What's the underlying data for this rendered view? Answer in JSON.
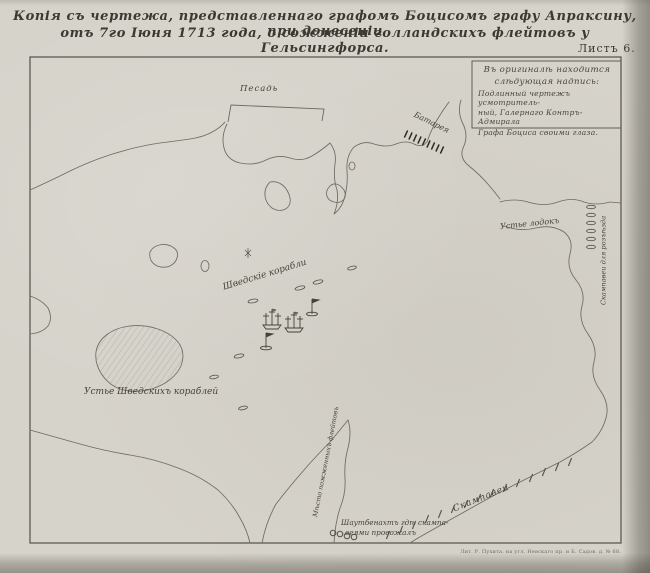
{
  "title": {
    "line1": "Копія съ чертежа, представленнаго графомъ Боцисомъ графу Апраксину, при донесеніи",
    "line2": "отъ 7го Іюня 1713 года, о сожженіи голландскихъ флейтовъ у Гельсингфорса.",
    "sheet": "Листъ 6."
  },
  "legend": {
    "lines": [
      "Въ оригиналѣ находится",
      "слѣдующая надпись:",
      "Подлинный чертежъ усмотритель-",
      "ный, Галернаго Контръ-Адмирала",
      "Графа Боциса своими глаза."
    ]
  },
  "labels": {
    "posad": "Песадь",
    "batareya": "Батарея",
    "ustye_lodok": "Устье лодокъ",
    "skampavei_razezd": "Скампавеи для розъѣзда",
    "shvedskie_korabli": "Шведскіе корабли",
    "ustye_shved": "Устье Шведскихъ кораблей",
    "mesto_flejtov": "Мѣсто пожженныхъ флейтовъ",
    "shautbenaht_1": "Шаутбенахтъ гдѣ скампа-",
    "shautbenaht_2": "веями провожалъ",
    "skampavei": "Скампавеи"
  },
  "imprint": "Лит. Р. Пухита, на угл. Невскаго пр. и Б. Садов. д. № 68.",
  "colors": {
    "paper": "#d6d3cb",
    "ink": "#46423a",
    "coast": "#6e6a62",
    "frame": "#55514a",
    "battery": "#2e2b26"
  }
}
